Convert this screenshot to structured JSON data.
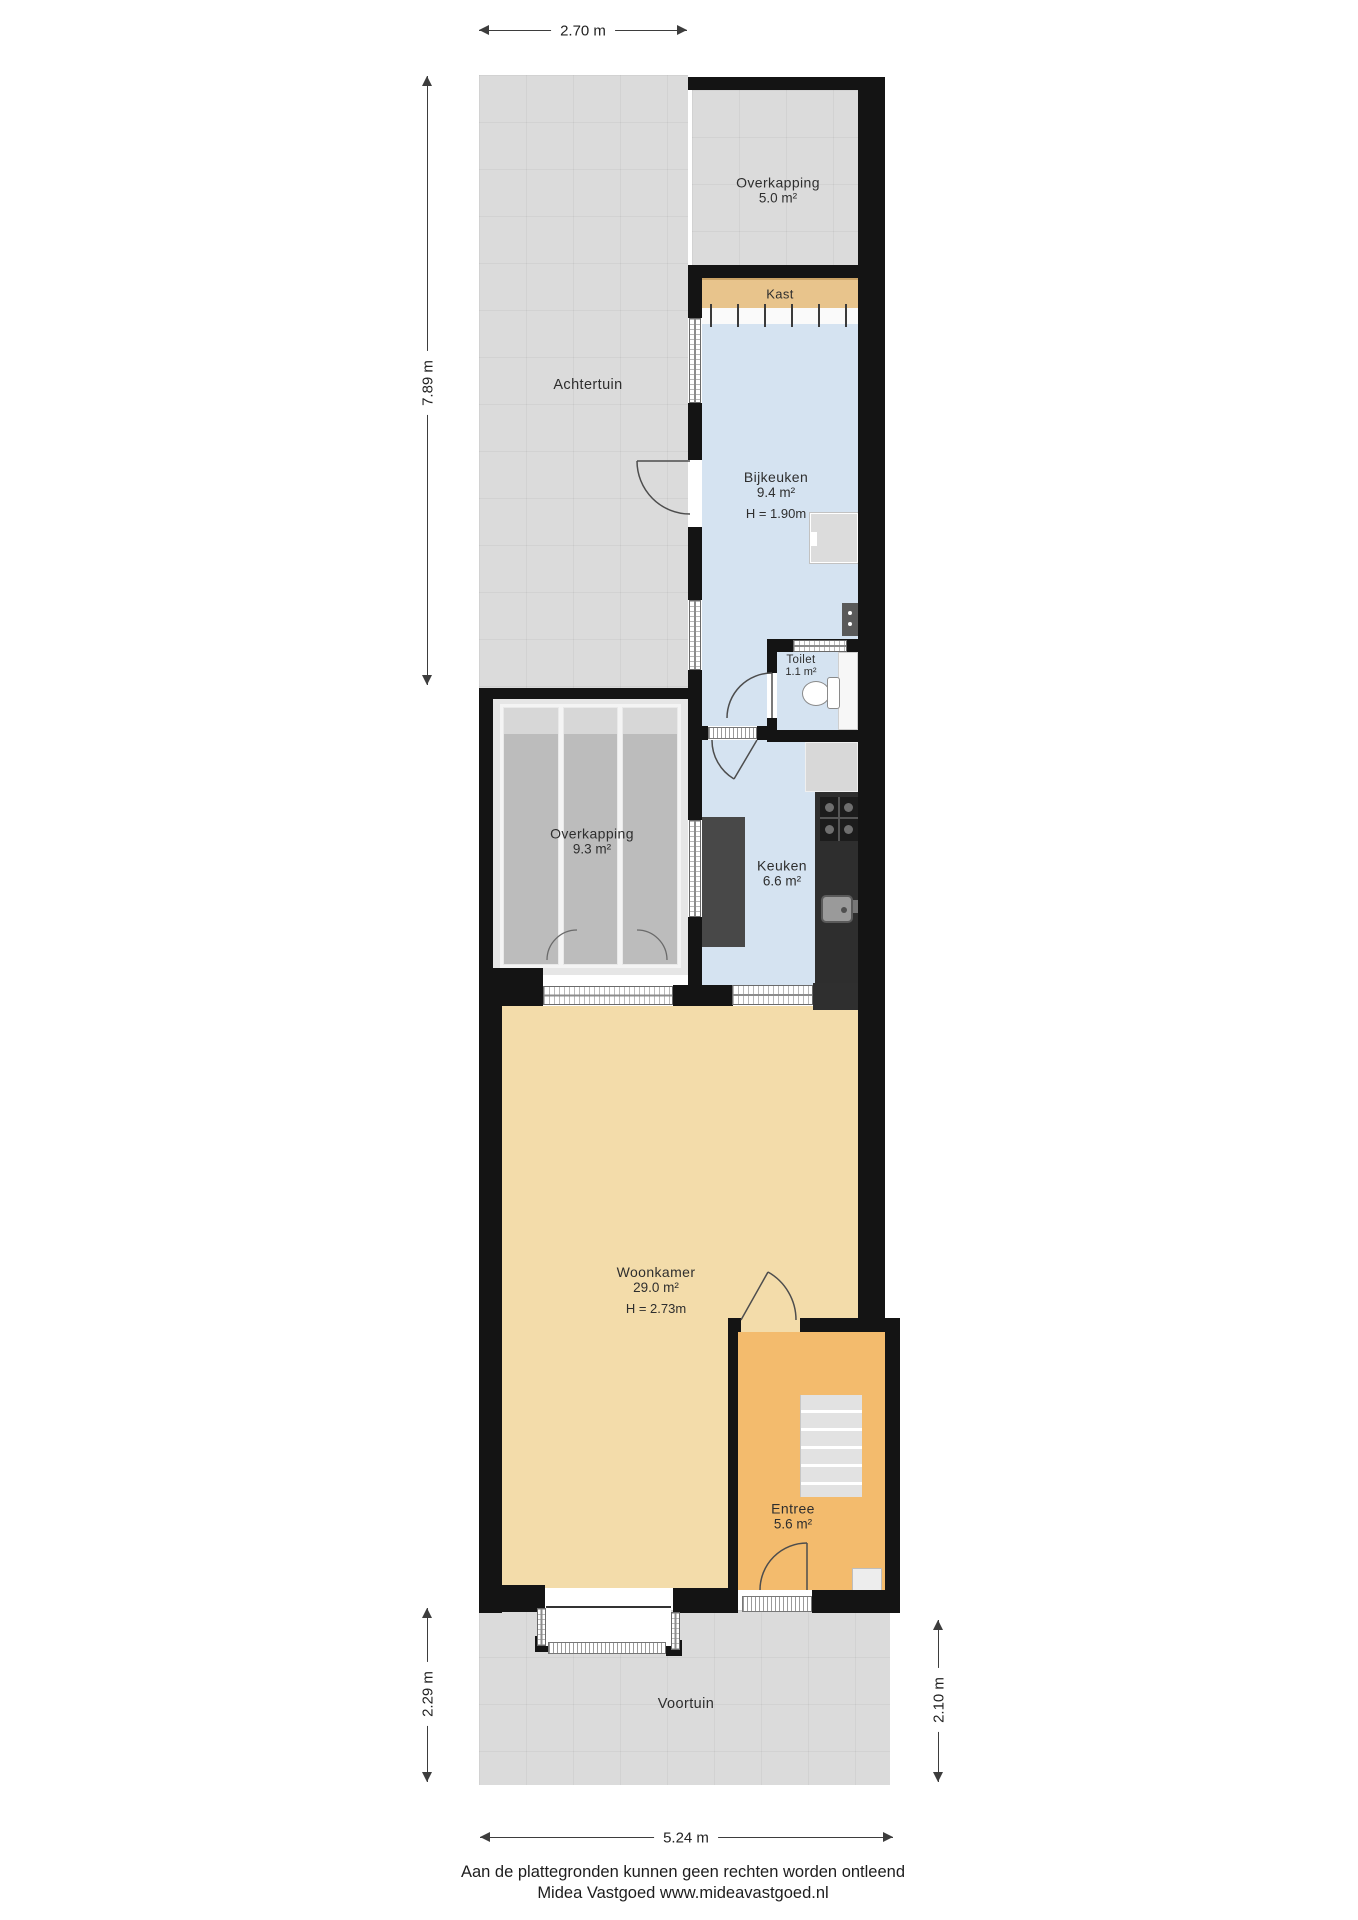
{
  "rooms": {
    "overkapping_boven": {
      "label": "Overkapping",
      "area": "5.0 m²"
    },
    "kast": {
      "label": "Kast"
    },
    "bijkeuken": {
      "label": "Bijkeuken",
      "area": "9.4 m²",
      "height": "H = 1.90m"
    },
    "toilet": {
      "label": "Toilet",
      "area": "1.1 m²"
    },
    "overkapping_midden": {
      "label": "Overkapping",
      "area": "9.3 m²"
    },
    "keuken": {
      "label": "Keuken",
      "area": "6.6 m²"
    },
    "woonkamer": {
      "label": "Woonkamer",
      "area": "29.0 m²",
      "height": "H = 2.73m"
    },
    "entree": {
      "label": "Entree",
      "area": "5.6 m²"
    }
  },
  "outdoor": {
    "achtertuin": {
      "label": "Achtertuin"
    },
    "voortuin": {
      "label": "Voortuin"
    }
  },
  "dimensions": {
    "top_width": {
      "value": "2.70 m"
    },
    "back_garden_depth": {
      "value": "7.89 m"
    },
    "front_left_depth": {
      "value": "2.29 m"
    },
    "front_right_depth": {
      "value": "2.10 m"
    },
    "bottom_width": {
      "value": "5.24 m"
    }
  },
  "footer": {
    "disclaimer": "Aan de plattegronden kunnen geen rechten worden ontleend",
    "company": "Midea Vastgoed www.mideavastgoed.nl"
  },
  "colors": {
    "wall": "#141414",
    "room_blue": "#d5e3f1",
    "room_beige": "#f3dcaa",
    "room_orange": "#f3bb6d",
    "kast_tan": "#e8c48c",
    "garden_gray": "#dbdbdb",
    "glass_panel_gray": "#bcbcbc"
  }
}
